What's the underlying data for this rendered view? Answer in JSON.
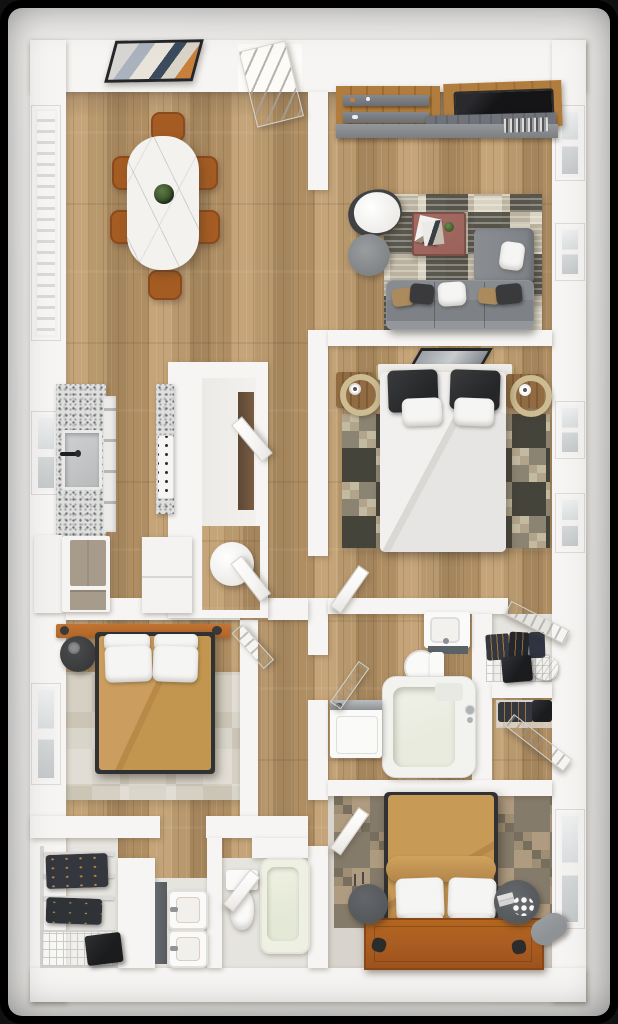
{
  "scene": {
    "kind": "3d-floorplan-top-view-render",
    "rooms": [
      {
        "id": "dining-room",
        "furniture": [
          "wall-art",
          "oval-marble-dining-table",
          "centerpiece-plant",
          "dining-chair",
          "dining-chair",
          "dining-chair",
          "dining-chair",
          "dining-chair",
          "dining-chair",
          "louvered-window"
        ]
      },
      {
        "id": "living-room",
        "furniture": [
          "media-wall-tv",
          "floating-shelves",
          "media-console",
          "patchwork-rug",
          "white-armchair",
          "gray-pouf",
          "coffee-table-with-magazines",
          "sectional-sofa",
          "throw-pillows",
          "window",
          "window"
        ]
      },
      {
        "id": "master-bedroom",
        "furniture": [
          "wall-art",
          "double-bed-white-duvet",
          "black-pillows",
          "white-pillows",
          "nightstand-with-brass-lamp",
          "nightstand-with-brass-lamp",
          "checkered-rug",
          "window",
          "window"
        ]
      },
      {
        "id": "kitchen",
        "furniture": [
          "granite-counter-with-sink",
          "cabinet-fronts",
          "range-with-knobs",
          "peninsula-granite",
          "pantry-unit",
          "refrigerator",
          "base-cabinet",
          "window"
        ]
      },
      {
        "id": "hallway",
        "furniture": [
          "alcove-round-table",
          "open-door",
          "open-door"
        ]
      },
      {
        "id": "bedroom-two",
        "furniture": [
          "cognac-headboard-bar",
          "double-bed-camel-duvet",
          "white-pillows",
          "round-black-nightstand",
          "beige-rug",
          "paneled-door",
          "window"
        ]
      },
      {
        "id": "walk-in-closet",
        "furniture": [
          "wire-shelving",
          "hanging-clothes",
          "wire-basket-stack",
          "black-hamper"
        ]
      },
      {
        "id": "bathroom-two",
        "furniture": [
          "double-sink-vanity",
          "toilet",
          "bathtub",
          "open-door"
        ]
      },
      {
        "id": "bathroom-one",
        "furniture": [
          "sink-vanity",
          "toilet",
          "bathtub-with-shower",
          "washing-machine",
          "open-door"
        ]
      },
      {
        "id": "linen-closet-a",
        "furniture": [
          "wire-shelf",
          "folded-clothes",
          "black-box",
          "white-bag",
          "sliding-door"
        ]
      },
      {
        "id": "linen-closet-b",
        "furniture": [
          "wire-rack",
          "clothes",
          "black-box",
          "open-door"
        ]
      },
      {
        "id": "bedroom-three",
        "furniture": [
          "double-bed-camel-duvet",
          "blanket-roll",
          "white-pillows",
          "leather-platform-headboard",
          "round-gray-nightstand",
          "round-gray-nightstand-with-flowers",
          "gray-bolster",
          "patchwork-floor-rug",
          "window",
          "open-door"
        ]
      }
    ]
  },
  "palette": {
    "frame_bg": "#000000",
    "ground": "#e9e8e6",
    "wall": "#f6f5f3",
    "wood": "#b8986d",
    "wood_light": "#c4a478",
    "wood_dark": "#a4855c",
    "granite_base": "#dededd",
    "granite_dot1": "#9fa1a3",
    "granite_dot2": "#707274",
    "granite_dot3": "#c3c4c5",
    "marble": "#f3f2ef",
    "chair": "#a55c22",
    "chair_dark": "#8a4a1d",
    "sofa": "#7e8286",
    "sofa_dark": "#6e7276",
    "cushion_white": "#f5f5f3",
    "pillow_tan": "#ab8a5d",
    "pillow_dark": "#3a3a3c",
    "pouf": "#898c8f",
    "table_brown": "#99625a",
    "tv_black": "#151517",
    "media_wood": "#b07d3f",
    "shelf_gray": "#75797d",
    "rug_cream": "#d9d3c2",
    "rug_olive": "#45443a",
    "rug_tan": "#b1a48a",
    "rug_graybrown": "#8c8472",
    "duvet_white": "#e6e5e3",
    "headboard": "#efede9",
    "brass": "#cdbc92",
    "nightstand_wood": "#916b41",
    "camel": "#c3964f",
    "cognac": "#b26627",
    "bedframe_dark": "#303133",
    "rug_bed2": "#d5d0c3",
    "black_table": "#3a3b3d",
    "patch_a": "#98876a",
    "patch_b": "#7d7260",
    "patch_c": "#ab9577",
    "patch_d": "#6e6452",
    "leather": "#a95c22",
    "gray_stand": "#55585b",
    "bolster": "#8f9295",
    "tub_cream": "#eef0e4",
    "tub_inner": "#e4e8d6",
    "porcelain": "#fafaf8",
    "slate": "#5a6268",
    "chrome": "#aeb2b6",
    "wire": "#cccbc8",
    "clothes_dark": "#34373d",
    "copper": "#c08648",
    "box_black": "#1b1c1e",
    "taupe_fridge": "#a79b8b",
    "window_pane": "#d3d6d7",
    "door_white": "#f7f6f4",
    "light_floor": "#e6e4df",
    "bed3_floor": "#d8d4cd",
    "art_frame": "#26262a",
    "art_accent": "#c87f3a",
    "art_dark": "#3c4a5e"
  }
}
